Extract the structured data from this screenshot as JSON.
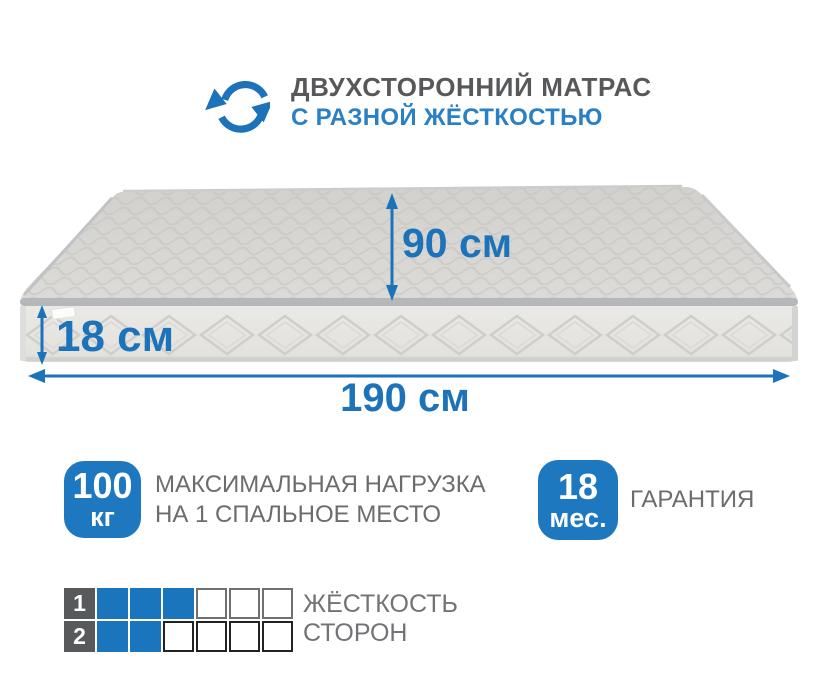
{
  "colors": {
    "accent": "#1c73b9",
    "accent-light": "#2b80c4",
    "badge": "#1d78c0",
    "title-gray": "#57585a",
    "text-gray": "#6b6c6e",
    "label-gray": "#727376",
    "square-blue": "#1a75bc",
    "square-label-bg": "#58595b"
  },
  "header": {
    "icon_name": "rotate-arrows-icon",
    "title": "ДВУХСТОРОННИЙ МАТРАС",
    "subtitle": "С РАЗНОЙ ЖЁСТКОСТЬЮ"
  },
  "mattress": {
    "depth": "90 см",
    "height": "18 см",
    "width": "190 см"
  },
  "features": [
    {
      "badge_value": "100",
      "badge_unit": "кг",
      "label_line1": "МАКСИМАЛЬНАЯ НАГРУЗКА",
      "label_line2": "НА 1 СПАЛЬНОЕ МЕСТО"
    },
    {
      "badge_value": "18",
      "badge_unit": "мес.",
      "label_line1": "ГАРАНТИЯ",
      "label_line2": ""
    }
  ],
  "hardness_scale": {
    "rows": [
      {
        "side": "1",
        "filled": 3,
        "total": 6
      },
      {
        "side": "2",
        "filled": 2,
        "total": 6
      }
    ],
    "label_line1": "ЖЁСТКОСТЬ",
    "label_line2": "СТОРОН"
  }
}
